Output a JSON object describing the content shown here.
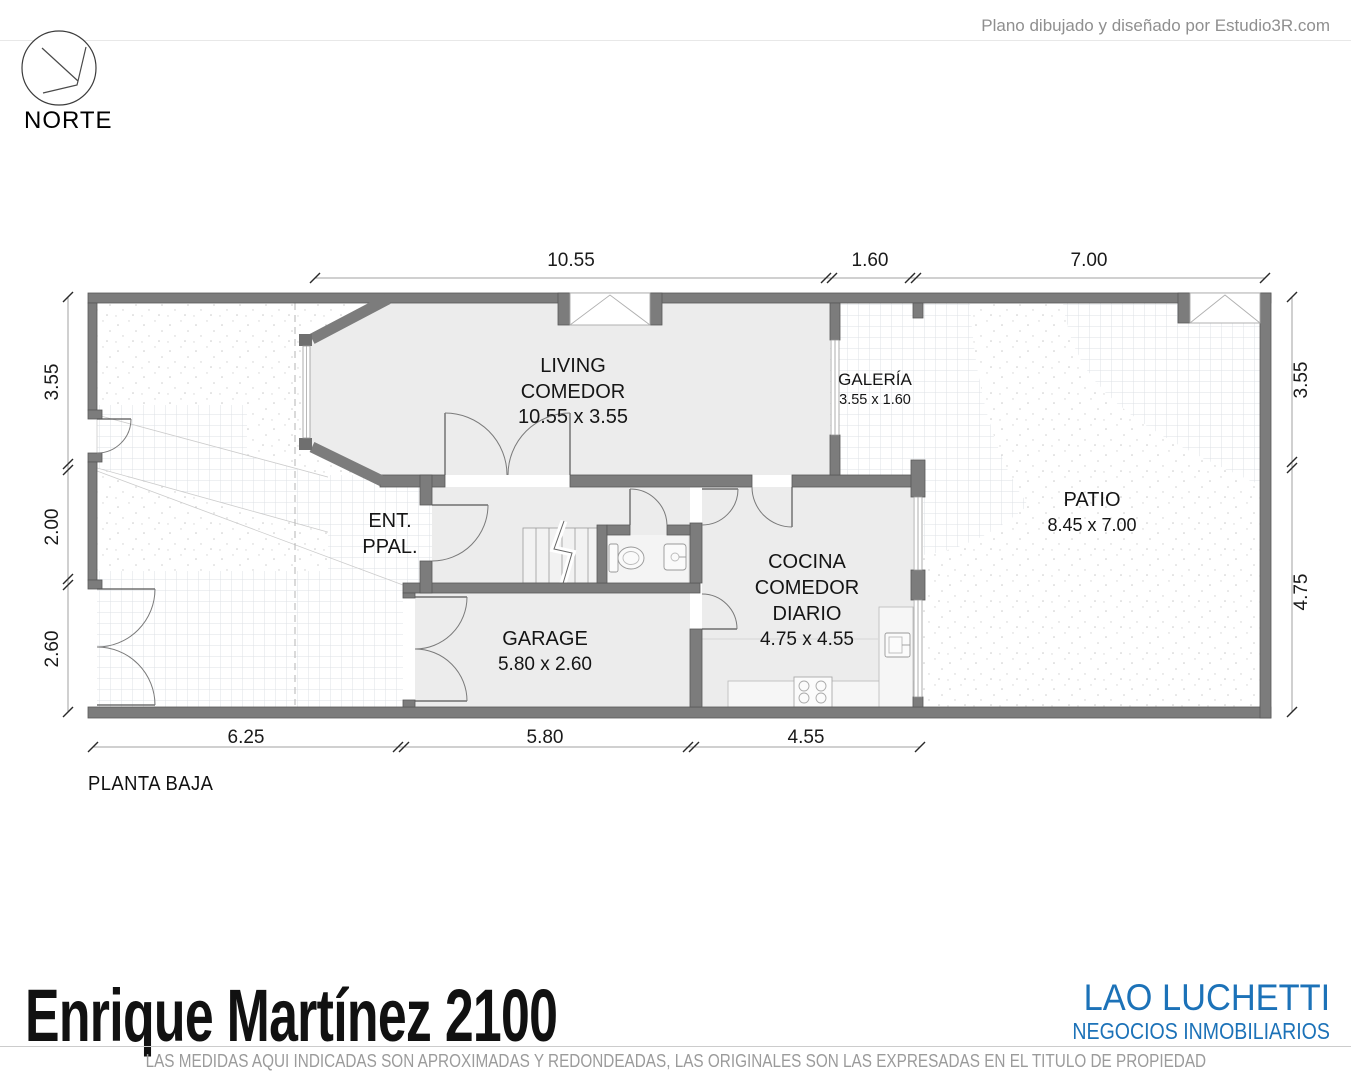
{
  "header": {
    "credit": "Plano dibujado y diseñado por Estudio3R.com"
  },
  "compass": {
    "label": "NORTE"
  },
  "plan": {
    "floor_label": "PLANTA BAJA",
    "rooms": {
      "living": {
        "line1": "LIVING",
        "line2": "COMEDOR",
        "size": "10.55 x 3.55"
      },
      "galeria": {
        "line1": "GALERÍA",
        "size": "3.55 x 1.60"
      },
      "patio": {
        "line1": "PATIO",
        "size": "8.45 x 7.00"
      },
      "entrada": {
        "line1": "ENT.",
        "line2": "PPAL."
      },
      "cocina": {
        "line1": "COCINA",
        "line2": "COMEDOR",
        "line3": "DIARIO",
        "size": "4.75 x 4.55"
      },
      "garage": {
        "line1": "GARAGE",
        "size": "5.80 x 2.60"
      }
    },
    "dimensions": {
      "top": [
        "10.55",
        "1.60",
        "7.00"
      ],
      "bottom": [
        "6.25",
        "5.80",
        "4.55"
      ],
      "left": [
        "3.55",
        "2.00",
        "2.60"
      ],
      "right": [
        "3.55",
        "4.75"
      ]
    }
  },
  "footer": {
    "title": "Enrique Martínez 2100",
    "brand": "LAO LUCHETTI",
    "brand_subtitle": "NEGOCIOS INMOBILIARIOS",
    "disclaimer": "LAS MEDIDAS AQUI INDICADAS SON APROXIMADAS Y REDONDEADAS, LAS ORIGINALES SON LAS EXPRESADAS EN EL TITULO DE PROPIEDAD"
  },
  "colors": {
    "brand_blue": "#1c72b8",
    "wall_gray": "#7c7c7c"
  }
}
